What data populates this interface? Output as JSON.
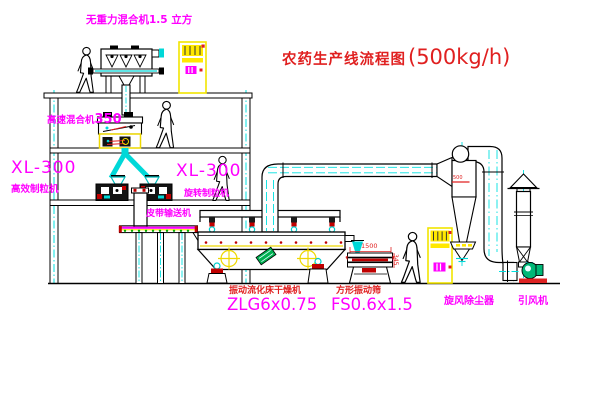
{
  "title": {
    "text": "农药生产线流程图",
    "capacity": "(500kg/h)"
  },
  "labels": {
    "gravity_mixer": "无重力混合机1.5 立方",
    "high_speed_mixer": "高速混合机",
    "high_speed_mixer_model": "350",
    "granulator_left_model": "XL-300",
    "granulator_left_name": "高效制粒机",
    "granulator_right_model": "XL-300",
    "granulator_right_name": "旋转制粒机",
    "belt_conveyor": "皮带输送机",
    "dryer_name": "振动流化床干燥机",
    "dryer_model": "ZLG6x0.75",
    "sieve_name": "方形振动筛",
    "sieve_model": "FS0.6x1.5",
    "cyclone": "旋风除尘器",
    "induced_draft_fan": "引风机"
  },
  "dimensions": {
    "sieve_length": "1500",
    "sieve_height": "345",
    "cyclone_level": "500"
  },
  "colors": {
    "label_magenta": "#ff00ff",
    "label_red": "#e02020",
    "line_black": "#000000",
    "centerline_cyan": "#00e0e0",
    "equipment_yellow": "#f2e400",
    "accent_red": "#c00000",
    "motor_green": "#00b050",
    "background": "#ffffff"
  }
}
